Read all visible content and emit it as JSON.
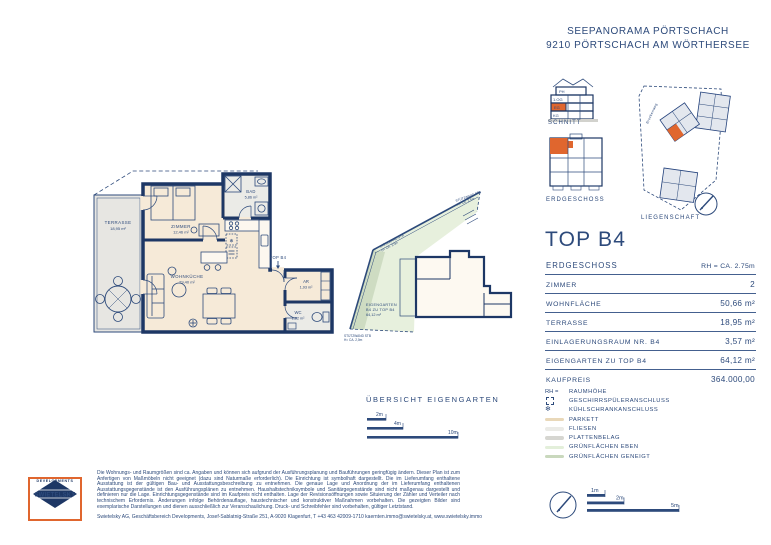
{
  "header": {
    "line1": "SEEPANORAMA PÖRTSCHACH",
    "line2": "9210 PÖRTSCHACH AM WÖRTHERSEE"
  },
  "colors": {
    "accent_orange": "#E0662E",
    "navy_text": "#2D4A7B",
    "wall_navy": "#1D3765",
    "parkett": "#E9D8B9",
    "fliesen": "#EBEBE7",
    "plattenbelag": "#D6D6D1",
    "gruen_eben": "#E3EFDA",
    "gruen_geneigt": "#C9D8BD"
  },
  "mini": {
    "schnitt_label": "SCHNITT",
    "floors": [
      "PH",
      "1.OG",
      "EG",
      "KG"
    ],
    "erdgeschoss_label": "ERDGESCHOSS",
    "liegenschaft_label": "LIEGENSCHAFT",
    "street": "Brockenweg"
  },
  "unit": {
    "title": "TOP B4"
  },
  "spec": {
    "header": {
      "label": "ERDGESCHOSS",
      "value": "RH = CA. 2.75m"
    },
    "rows": [
      {
        "label": "ZIMMER",
        "value": "2"
      },
      {
        "label": "WOHNFLÄCHE",
        "value": "50,66 m²"
      },
      {
        "label": "TERRASSE",
        "value": "18,95 m²"
      },
      {
        "label": "EINLAGERUNGSRAUM NR. B4",
        "value": "3,57 m²"
      },
      {
        "label": "EIGENGARTEN ZU TOP B4",
        "value": "64,12 m²"
      },
      {
        "label": "KAUFPREIS",
        "value": "364.000,00"
      }
    ]
  },
  "legend": {
    "rows": [
      {
        "key": "RH =",
        "label": "RAUMHÖHE"
      },
      {
        "key": "",
        "label": "GESCHIRRSPÜLERANSCHLUSS"
      },
      {
        "key": "❄",
        "label": "KÜHLSCHRANKANSCHLUSS"
      },
      {
        "key": "",
        "label": "PARKETT"
      },
      {
        "key": "",
        "label": "FLIESEN"
      },
      {
        "key": "",
        "label": "PLATTENBELAG"
      },
      {
        "key": "",
        "label": "GRÜNFLÄCHEN EBEN"
      },
      {
        "key": "",
        "label": "GRÜNFLÄCHEN GENEIGT"
      }
    ]
  },
  "plan": {
    "terrasse": {
      "name": "TERRASSE",
      "area": "18,95 m²"
    },
    "zimmer": {
      "name": "ZIMMER",
      "area": "12,46 m²"
    },
    "bad": {
      "name": "BAD",
      "area": "5,86 m²"
    },
    "wohnkueche": {
      "name": "WOHNKÜCHE",
      "area": "29,40 m²"
    },
    "entry": {
      "label": "TOP B4"
    },
    "ar": {
      "name": "AR",
      "area": "1,93 m²"
    },
    "wc": {
      "name": "WC",
      "area": "1,82 m²"
    }
  },
  "garden": {
    "label_line1": "EIGENGARTEN",
    "label_line2": "B4 ZU TOP B4",
    "label_line3": "64,12 m²",
    "wall1_line1": "STÜTZWAND STB",
    "wall1_line2": "H= CA. 2,5m",
    "wall2_line1": "STÜTZWAND STB",
    "wall2_line2": "H= CA. 2,5m",
    "wall3_line1": "STÜTZWAND STB",
    "wall3_line2": "H= CA. 2,0m"
  },
  "uebersicht": {
    "title": "ÜBERSICHT EIGENGARTEN",
    "scale": [
      "2m",
      "4m",
      "10m"
    ]
  },
  "scalebar": {
    "labels": [
      "1m",
      "2m",
      "5m"
    ]
  },
  "logo": {
    "name": "SWIETELSKY",
    "sub": "DEVELOPMENTS"
  },
  "footer": {
    "disclaimer": "Die Wohnungs- und Raumgrößen sind ca. Angaben und können sich aufgrund der Ausführungsplanung und Bauführungen geringfügig ändern. Dieser Plan ist zum Anfertigen von Maßmöbeln nicht geeignet (dazu sind Naturmaße erforderlich). Die Einrichtung ist symbolhaft dargestellt. Die im Lieferumfang enthaltene Ausstattung ist der gültigen Bau- und Ausstattungsbeschreibung zu entnehmen. Die genaue Lage und Anordnung der im Lieferumfang enthaltenen Ausstattungsgegenstände ist den Ausführungsplänen zu entnehmen. Haushaltstechniksymbole und Sanitärgegenstände sind nicht maßgenau dargestellt und definieren nur die Lage. Einrichtungsgegenstände sind im Kaufpreis nicht enthalten. Lage der Revisionsöffnungen sowie Situierung der Zähler und Verteiler nach technischem Erfordernis. Änderungen infolge Behördenauflage, haustechnischer und konstruktiver Maßnahmen vorbehalten. Die gezeigten Bilder sind exemplarische Darstellungen und dienen ausschließlich zur Veranschaulichung. Druck- und Schreibfehler sind vorbehalten, gültiger Letztstand.",
    "company": "Swietelsky AG, Geschäftsbereich Developments, Josef-Sablatnig-Straße 251, A-9020 Klagenfurt, T +43 463 42009-1710 kaernten.immo@swietelsky.at, www.swietelsky.immo"
  }
}
